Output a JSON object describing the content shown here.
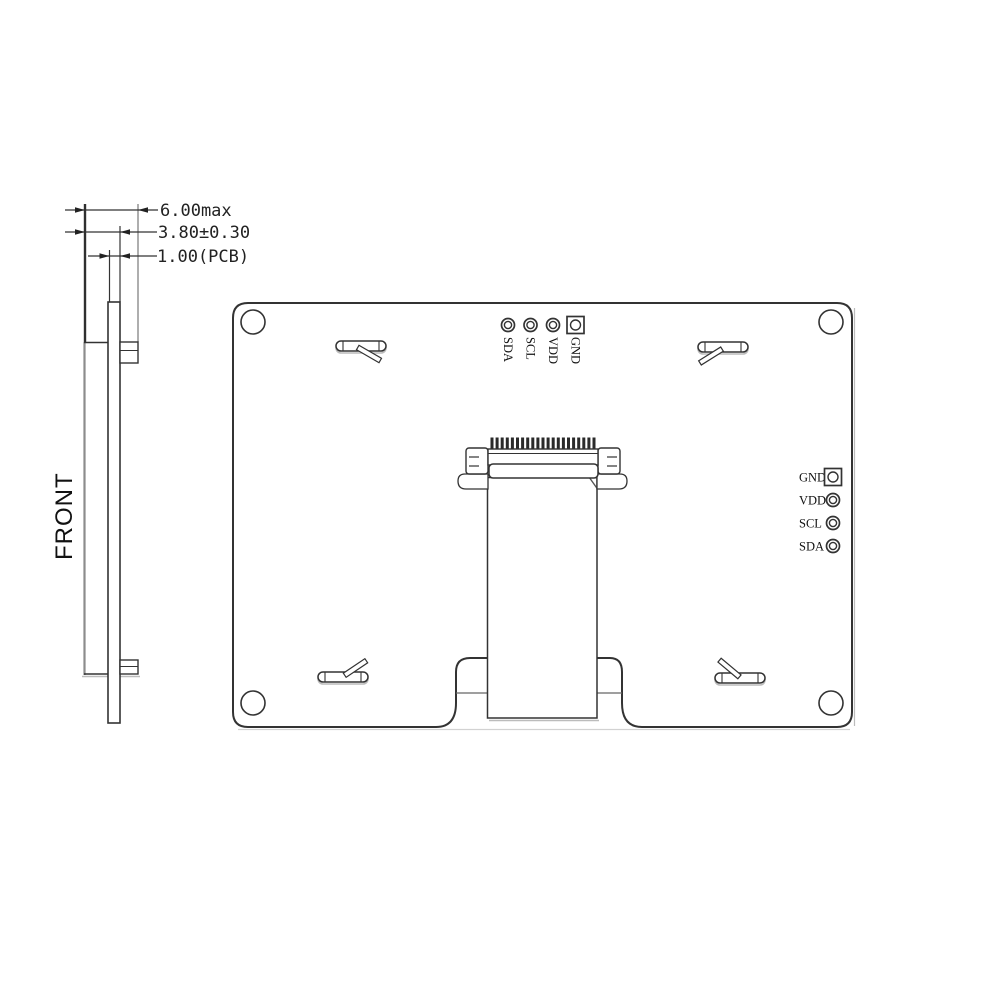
{
  "side_view": {
    "view_label": "FRONT",
    "dimensions": [
      {
        "label": "6.00max"
      },
      {
        "label": "3.80±0.30"
      },
      {
        "label": "1.00(PCB)"
      }
    ]
  },
  "back_view": {
    "top_pins": [
      {
        "label": "SDA"
      },
      {
        "label": "SCL"
      },
      {
        "label": "VDD"
      },
      {
        "label": "GND"
      }
    ],
    "right_pins": [
      {
        "label": "GND"
      },
      {
        "label": "VDD"
      },
      {
        "label": "SCL"
      },
      {
        "label": "SDA"
      }
    ]
  },
  "colors": {
    "line": "#333333",
    "light_line": "#8c8c8c",
    "shadow": "#bcbcbc",
    "text": "#1a1a1a",
    "background": "#ffffff"
  }
}
